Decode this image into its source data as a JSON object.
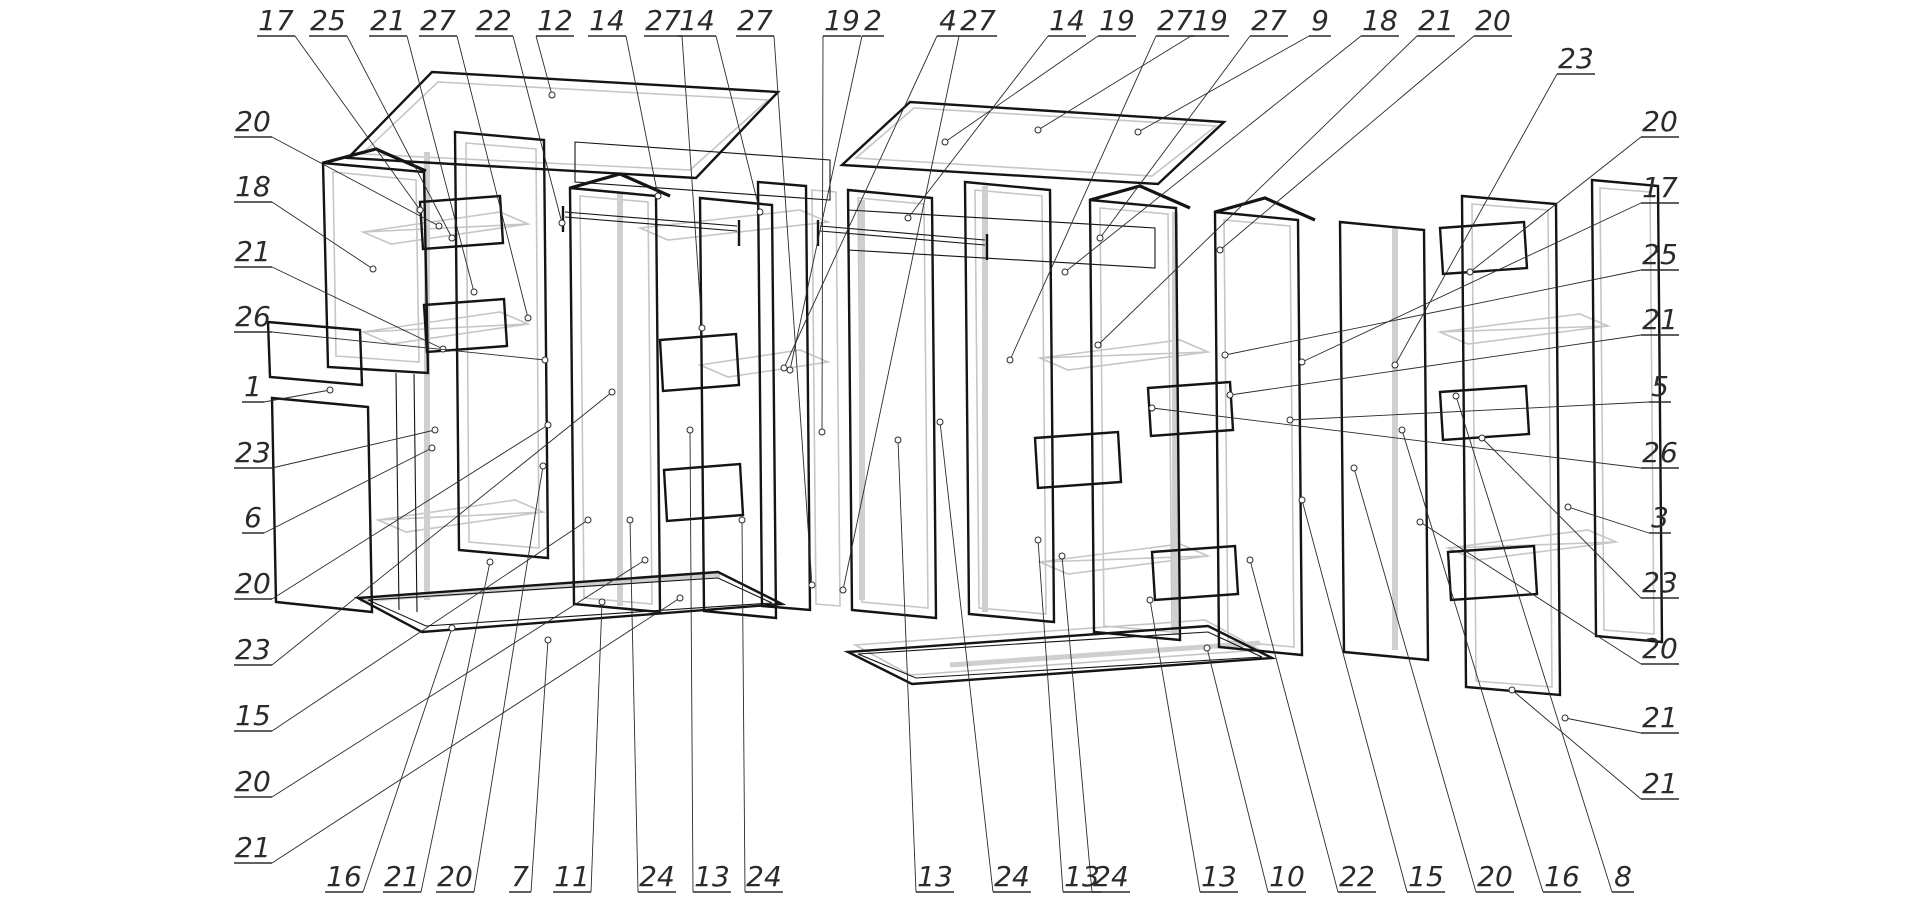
{
  "document": {
    "type": "exploded-view technical drawing",
    "subject": "wardrobe cabinet assembly with numbered part callouts",
    "background_color": "#ffffff",
    "line_color": "#141414",
    "ghost_line_color": "#c6c6c6",
    "label_color": "#2b2b2b",
    "part_numbers_visible": [
      "1",
      "2",
      "3",
      "4",
      "5",
      "6",
      "7",
      "8",
      "9",
      "10",
      "11",
      "12",
      "13",
      "14",
      "15",
      "16",
      "17",
      "18",
      "19",
      "20",
      "21",
      "22",
      "23",
      "24",
      "25",
      "26",
      "27"
    ],
    "callouts": [
      {
        "text": "17",
        "x": 276,
        "y": 30,
        "tx": 420,
        "ty": 210
      },
      {
        "text": "25",
        "x": 328,
        "y": 30,
        "tx": 452,
        "ty": 238
      },
      {
        "text": "21",
        "x": 388,
        "y": 30,
        "tx": 474,
        "ty": 292
      },
      {
        "text": "27",
        "x": 438,
        "y": 30,
        "tx": 528,
        "ty": 318
      },
      {
        "text": "22",
        "x": 494,
        "y": 30,
        "tx": 562,
        "ty": 223
      },
      {
        "text": "12",
        "x": 555,
        "y": 30,
        "tx": 552,
        "ty": 95
      },
      {
        "text": "14",
        "x": 607,
        "y": 30,
        "tx": 658,
        "ty": 196
      },
      {
        "text": "27",
        "x": 663,
        "y": 30,
        "tx": 702,
        "ty": 328
      },
      {
        "text": "14",
        "x": 697,
        "y": 30,
        "tx": 760,
        "ty": 212
      },
      {
        "text": "27",
        "x": 755,
        "y": 30,
        "tx": 812,
        "ty": 585
      },
      {
        "text": "19",
        "x": 842,
        "y": 30,
        "tx": 822,
        "ty": 432
      },
      {
        "text": "2",
        "x": 873,
        "y": 30,
        "tx": 790,
        "ty": 370
      },
      {
        "text": "4",
        "x": 948,
        "y": 30,
        "tx": 784,
        "ty": 368
      },
      {
        "text": "27",
        "x": 978,
        "y": 30,
        "tx": 843,
        "ty": 590
      },
      {
        "text": "14",
        "x": 1067,
        "y": 30,
        "tx": 908,
        "ty": 218
      },
      {
        "text": "19",
        "x": 1117,
        "y": 30,
        "tx": 945,
        "ty": 142
      },
      {
        "text": "27",
        "x": 1175,
        "y": 30,
        "tx": 1010,
        "ty": 360
      },
      {
        "text": "19",
        "x": 1210,
        "y": 30,
        "tx": 1038,
        "ty": 130
      },
      {
        "text": "27",
        "x": 1269,
        "y": 30,
        "tx": 1100,
        "ty": 238
      },
      {
        "text": "9",
        "x": 1320,
        "y": 30,
        "tx": 1138,
        "ty": 132
      },
      {
        "text": "18",
        "x": 1380,
        "y": 30,
        "tx": 1065,
        "ty": 272
      },
      {
        "text": "21",
        "x": 1436,
        "y": 30,
        "tx": 1098,
        "ty": 345
      },
      {
        "text": "20",
        "x": 1493,
        "y": 30,
        "tx": 1220,
        "ty": 250
      },
      {
        "text": "20",
        "x": 253,
        "y": 131,
        "tx": 439,
        "ty": 226
      },
      {
        "text": "18",
        "x": 253,
        "y": 196,
        "tx": 373,
        "ty": 269
      },
      {
        "text": "21",
        "x": 253,
        "y": 261,
        "tx": 443,
        "ty": 349
      },
      {
        "text": "26",
        "x": 253,
        "y": 326,
        "tx": 545,
        "ty": 360
      },
      {
        "text": "1",
        "x": 253,
        "y": 396,
        "tx": 330,
        "ty": 390
      },
      {
        "text": "23",
        "x": 253,
        "y": 462,
        "tx": 435,
        "ty": 430
      },
      {
        "text": "6",
        "x": 253,
        "y": 527,
        "tx": 432,
        "ty": 448
      },
      {
        "text": "20",
        "x": 253,
        "y": 593,
        "tx": 548,
        "ty": 425
      },
      {
        "text": "23",
        "x": 253,
        "y": 659,
        "tx": 612,
        "ty": 392
      },
      {
        "text": "15",
        "x": 253,
        "y": 725,
        "tx": 588,
        "ty": 520
      },
      {
        "text": "20",
        "x": 253,
        "y": 791,
        "tx": 645,
        "ty": 560
      },
      {
        "text": "21",
        "x": 253,
        "y": 857,
        "tx": 680,
        "ty": 598
      },
      {
        "text": "23",
        "x": 1576,
        "y": 68,
        "tx": 1395,
        "ty": 365
      },
      {
        "text": "20",
        "x": 1660,
        "y": 131,
        "tx": 1470,
        "ty": 272
      },
      {
        "text": "17",
        "x": 1660,
        "y": 197,
        "tx": 1302,
        "ty": 362
      },
      {
        "text": "25",
        "x": 1660,
        "y": 264,
        "tx": 1225,
        "ty": 355
      },
      {
        "text": "21",
        "x": 1660,
        "y": 329,
        "tx": 1230,
        "ty": 395
      },
      {
        "text": "5",
        "x": 1660,
        "y": 396,
        "tx": 1290,
        "ty": 420
      },
      {
        "text": "26",
        "x": 1660,
        "y": 462,
        "tx": 1152,
        "ty": 408
      },
      {
        "text": "3",
        "x": 1660,
        "y": 527,
        "tx": 1568,
        "ty": 507
      },
      {
        "text": "23",
        "x": 1660,
        "y": 592,
        "tx": 1482,
        "ty": 438
      },
      {
        "text": "20",
        "x": 1660,
        "y": 658,
        "tx": 1420,
        "ty": 522
      },
      {
        "text": "21",
        "x": 1660,
        "y": 727,
        "tx": 1565,
        "ty": 718
      },
      {
        "text": "21",
        "x": 1660,
        "y": 793,
        "tx": 1512,
        "ty": 690
      },
      {
        "text": "16",
        "x": 344,
        "y": 886,
        "tx": 452,
        "ty": 628
      },
      {
        "text": "21",
        "x": 402,
        "y": 886,
        "tx": 490,
        "ty": 562
      },
      {
        "text": "20",
        "x": 455,
        "y": 886,
        "tx": 543,
        "ty": 466
      },
      {
        "text": "7",
        "x": 520,
        "y": 886,
        "tx": 548,
        "ty": 640
      },
      {
        "text": "11",
        "x": 572,
        "y": 886,
        "tx": 602,
        "ty": 602
      },
      {
        "text": "24",
        "x": 657,
        "y": 886,
        "tx": 630,
        "ty": 520
      },
      {
        "text": "13",
        "x": 712,
        "y": 886,
        "tx": 690,
        "ty": 430
      },
      {
        "text": "24",
        "x": 764,
        "y": 886,
        "tx": 742,
        "ty": 520
      },
      {
        "text": "13",
        "x": 935,
        "y": 886,
        "tx": 898,
        "ty": 440
      },
      {
        "text": "24",
        "x": 1012,
        "y": 886,
        "tx": 940,
        "ty": 422
      },
      {
        "text": "13",
        "x": 1082,
        "y": 886,
        "tx": 1038,
        "ty": 540
      },
      {
        "text": "24",
        "x": 1111,
        "y": 886,
        "tx": 1062,
        "ty": 556
      },
      {
        "text": "13",
        "x": 1219,
        "y": 886,
        "tx": 1150,
        "ty": 600
      },
      {
        "text": "10",
        "x": 1287,
        "y": 886,
        "tx": 1207,
        "ty": 648
      },
      {
        "text": "22",
        "x": 1357,
        "y": 886,
        "tx": 1250,
        "ty": 560
      },
      {
        "text": "15",
        "x": 1426,
        "y": 886,
        "tx": 1302,
        "ty": 500
      },
      {
        "text": "20",
        "x": 1495,
        "y": 886,
        "tx": 1354,
        "ty": 468
      },
      {
        "text": "16",
        "x": 1562,
        "y": 886,
        "tx": 1402,
        "ty": 430
      },
      {
        "text": "8",
        "x": 1623,
        "y": 886,
        "tx": 1456,
        "ty": 396
      }
    ]
  }
}
